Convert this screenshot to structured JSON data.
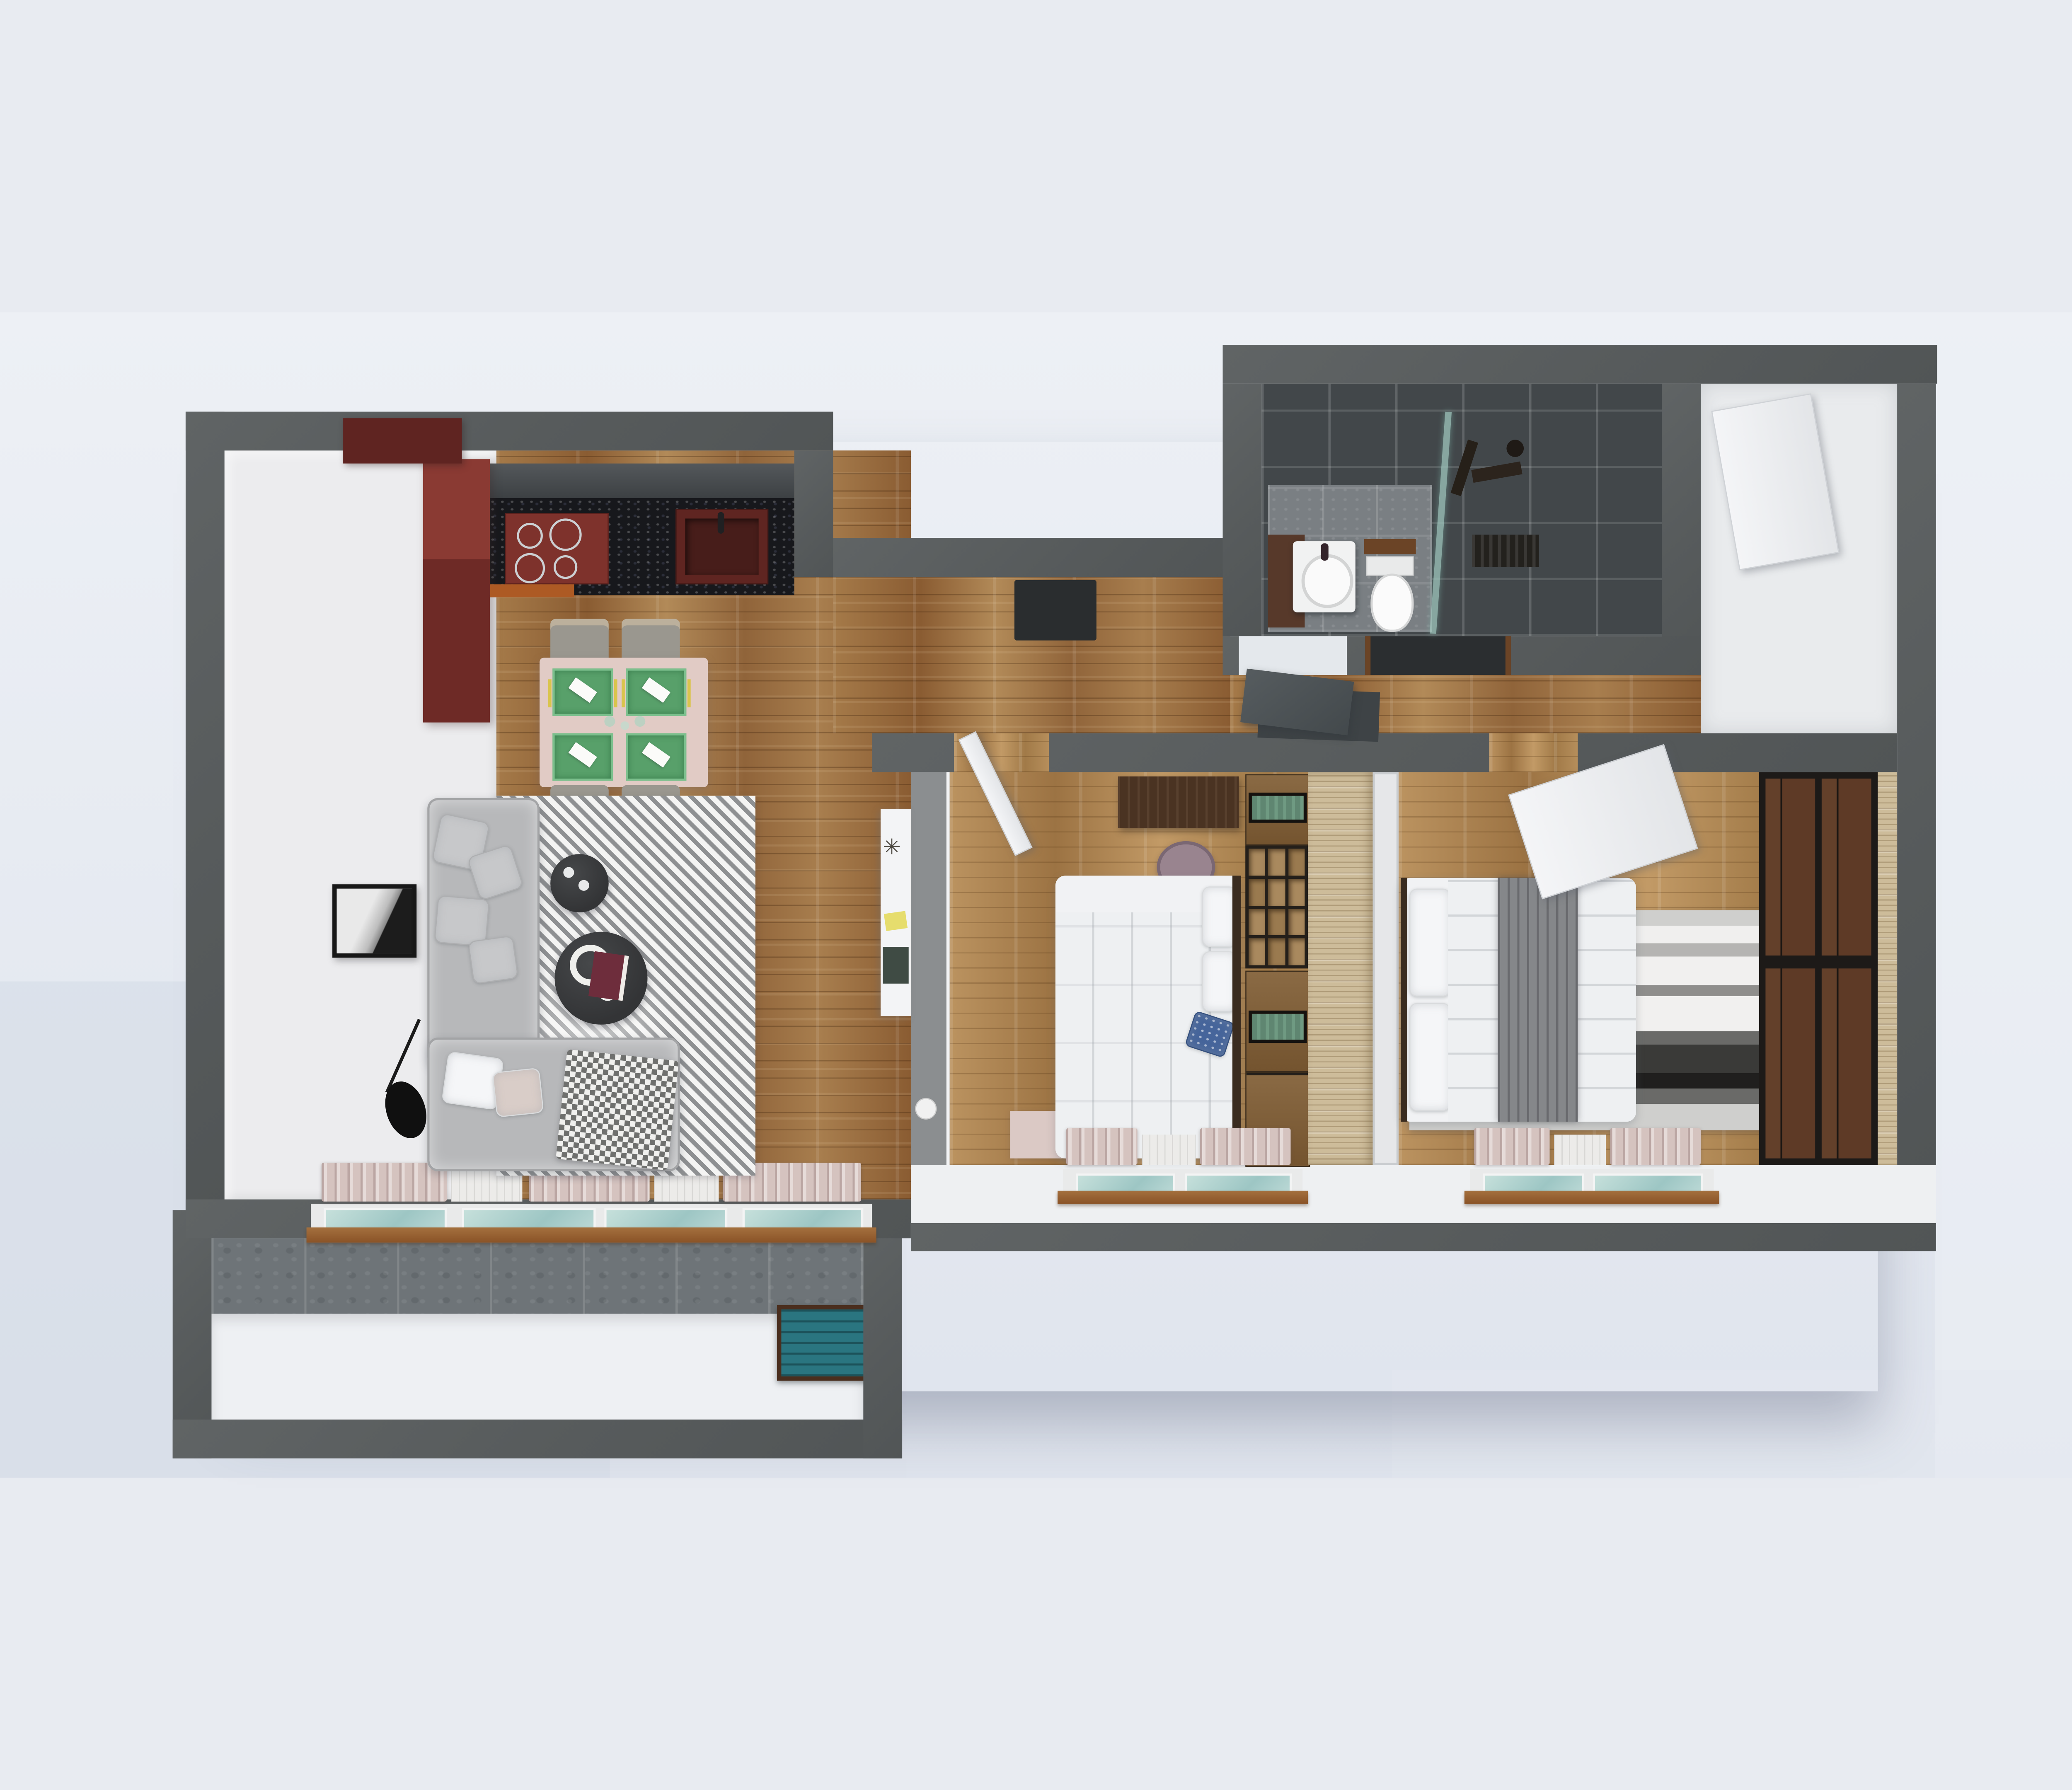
{
  "scene": {
    "type": "3d-apartment-floor-plan-render",
    "view": "top-down cutaway",
    "background_color": "#e8ebf1",
    "wall_color": "#595d5e",
    "text_visible": "none"
  },
  "palette": {
    "outer_wall": "#595d5e",
    "interior_white": "#ececee",
    "wood_floor": "#96693c",
    "wood_floor_bedrooms": "#b08a55",
    "kitchen_red": "#6e2a26",
    "kitchen_hood_red": "#8a3a33",
    "kitchen_counter_black": "#17181c",
    "kitchen_orange_accent": "#ad5a24",
    "dining_table_pink": "#e1cbc5",
    "placemat_green": "#58a06a",
    "cutlery_yellow": "#d9c44c",
    "sofa_gray": "#b7b8ba",
    "rug_stripe_gray": "#8e9092",
    "coffee_table_charcoal": "#38393b",
    "book_cover_red": "#6e2d3c",
    "bathroom_tile_dark": "#42474a",
    "bathroom_floor_gray": "#7a7f83",
    "vanity_brown": "#57392a",
    "shower_glass_teal": "#9fc6bd",
    "bed_linen_white": "#f1f2f4",
    "pillow_blue": "#46659b",
    "throw_gray": "#85878a",
    "wardrobe1_light_wood": "#cdbc9a",
    "wardrobe2_brown": "#5e3a26",
    "wardrobe2_frame_black": "#1d1a18",
    "cabinet_glass_green": "#5f8671",
    "window_glass_teal": "#aed4d2",
    "window_sill_brown": "#9a6234",
    "curtain_pink": "#d5c3bf",
    "curtain_sheer": "#ecebe9",
    "balcony_crate_teal": "#2a7580",
    "balcony_concrete": "#6e7478",
    "entrance_door_slate": "#4d5356"
  },
  "icons": {
    "twigs": "✳"
  },
  "rooms": [
    {
      "id": "living-kitchen",
      "name": "Living room with open kitchen",
      "furniture": [
        "red kitchen cabinets with hood",
        "black speckled counter",
        "cooktop with 4 burners",
        "kitchen sink",
        "upper cabinets",
        "dining table for 4 with green placemats",
        "4 dining chairs",
        "L-shaped gray sectional sofa",
        "8 cushions",
        "houndstooth throw",
        "diagonal striped area rug",
        "2 round charcoal coffee tables",
        "wine glasses, bowl, cup, book",
        "black floor lamp",
        "framed monochrome artwork",
        "white console with twigs, notes, green book",
        "sliding window with pink and sheer curtains"
      ]
    },
    {
      "id": "hallway",
      "name": "Entrance hallway",
      "furniture": [
        "slate entrance door",
        "dark doormat",
        "ceiling light panel",
        "white vase"
      ]
    },
    {
      "id": "bathroom",
      "name": "Bathroom",
      "furniture": [
        "brown vanity with white basin",
        "toilet",
        "teal glass shower partition",
        "black shower set",
        "floor drain"
      ]
    },
    {
      "id": "utility",
      "name": "Utility room",
      "furniture": [
        "leaning white door panel"
      ]
    },
    {
      "id": "bedroom-1",
      "name": "Bedroom 1",
      "furniture": [
        "double bed with white duvet",
        "white and blue pillows",
        "dark walnut desk",
        "mauve chair",
        "cube shelving unit",
        "cabinets with green glass doors",
        "light wood wardrobe",
        "pale pink rug",
        "window with curtains",
        "open white door"
      ]
    },
    {
      "id": "bedroom-2",
      "name": "Bedroom 2",
      "furniture": [
        "double bed with gray throw",
        "striped gray-black rug",
        "brown wardrobe with black frame",
        "open white door panel",
        "window with curtains"
      ]
    },
    {
      "id": "balcony",
      "name": "Balcony",
      "furniture": [
        "concrete tiled parapet",
        "teal storage crate"
      ]
    }
  ]
}
